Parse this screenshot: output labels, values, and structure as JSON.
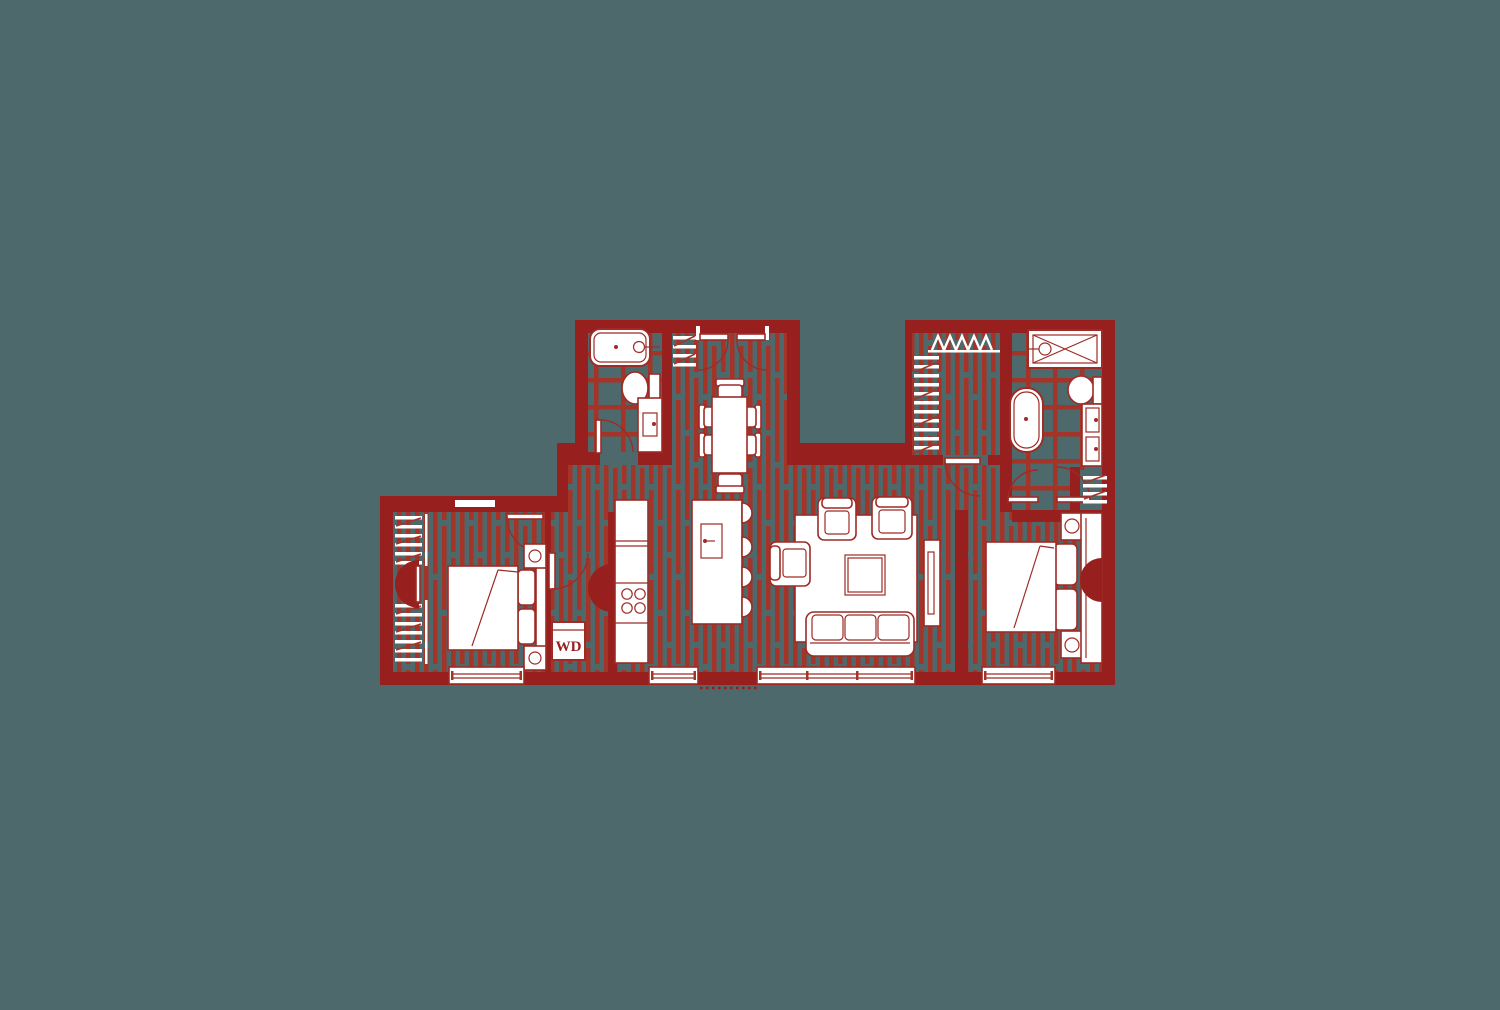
{
  "labels": {
    "washer_dryer": "WD"
  },
  "colors": {
    "background": "#4e696c",
    "wall": "#97201f",
    "floor_line": "#a43427",
    "fixture_stroke": "#9d2b26",
    "white": "#ffffff"
  }
}
